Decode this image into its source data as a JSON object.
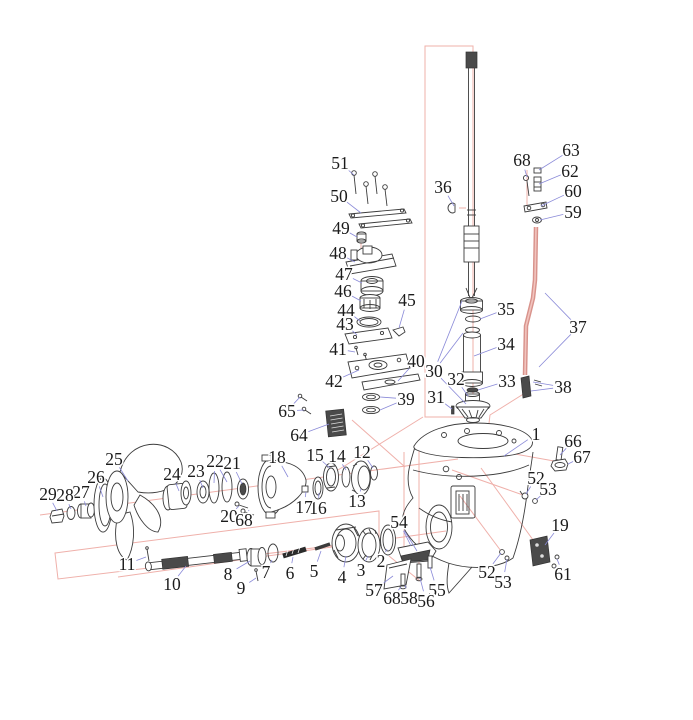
{
  "diagram": {
    "type": "exploded-parts-diagram",
    "colors": {
      "label": "#1b1b1b",
      "leader": "#8a8ad8",
      "assoc": "#efb0aa",
      "ink": "#3c3c3c",
      "rod": "#d8938c"
    },
    "labels": [
      {
        "id": "1",
        "text": "1",
        "x": 536,
        "y": 434,
        "leaders": [
          [
            504,
            456
          ]
        ]
      },
      {
        "id": "2",
        "text": "2",
        "x": 381,
        "y": 561,
        "leaders": [
          [
            387,
            549
          ]
        ]
      },
      {
        "id": "3",
        "text": "3",
        "x": 361,
        "y": 570,
        "leaders": [
          [
            368,
            556
          ]
        ]
      },
      {
        "id": "4",
        "text": "4",
        "x": 342,
        "y": 577,
        "leaders": [
          [
            346,
            556
          ]
        ]
      },
      {
        "id": "5",
        "text": "5",
        "x": 314,
        "y": 571,
        "leaders": [
          [
            321,
            551
          ]
        ]
      },
      {
        "id": "6",
        "text": "6",
        "x": 290,
        "y": 573,
        "leaders": [
          [
            293,
            557
          ]
        ]
      },
      {
        "id": "7",
        "text": "7",
        "x": 266,
        "y": 572,
        "leaders": [
          [
            272,
            560
          ]
        ]
      },
      {
        "id": "8",
        "text": "8",
        "x": 228,
        "y": 574,
        "leaders": [
          [
            250,
            561
          ]
        ]
      },
      {
        "id": "9",
        "text": "9",
        "x": 241,
        "y": 588,
        "leaders": [
          [
            256,
            578
          ]
        ]
      },
      {
        "id": "10",
        "text": "10",
        "x": 172,
        "y": 584,
        "leaders": [
          [
            186,
            566
          ]
        ]
      },
      {
        "id": "11",
        "text": "11",
        "x": 127,
        "y": 564,
        "leaders": [
          [
            146,
            557
          ]
        ]
      },
      {
        "id": "12",
        "text": "12",
        "x": 362,
        "y": 452,
        "leaders": [
          [
            373,
            468
          ]
        ]
      },
      {
        "id": "13",
        "text": "13",
        "x": 357,
        "y": 501,
        "leaders": [
          [
            361,
            489
          ]
        ]
      },
      {
        "id": "14",
        "text": "14",
        "x": 337,
        "y": 456,
        "leaders": [
          [
            346,
            470
          ]
        ]
      },
      {
        "id": "15",
        "text": "15",
        "x": 315,
        "y": 455,
        "leaders": [
          [
            330,
            468
          ]
        ]
      },
      {
        "id": "16",
        "text": "16",
        "x": 318,
        "y": 508,
        "leaders": [
          [
            319,
            493
          ]
        ]
      },
      {
        "id": "17",
        "text": "17",
        "x": 304,
        "y": 507,
        "leaders": [
          [
            306,
            492
          ]
        ]
      },
      {
        "id": "18",
        "text": "18",
        "x": 277,
        "y": 457,
        "leaders": [
          [
            288,
            477
          ]
        ]
      },
      {
        "id": "19",
        "text": "19",
        "x": 560,
        "y": 525,
        "leaders": [
          [
            545,
            545
          ]
        ]
      },
      {
        "id": "20",
        "text": "20",
        "x": 229,
        "y": 516,
        "leaders": [
          [
            239,
            506
          ]
        ]
      },
      {
        "id": "21",
        "text": "21",
        "x": 232,
        "y": 463,
        "leaders": [
          [
            242,
            484
          ]
        ]
      },
      {
        "id": "22",
        "text": "22",
        "x": 215,
        "y": 461,
        "leaders": [
          [
            214,
            483
          ],
          [
            227,
            482
          ]
        ]
      },
      {
        "id": "23",
        "text": "23",
        "x": 196,
        "y": 471,
        "leaders": [
          [
            203,
            488
          ]
        ]
      },
      {
        "id": "24",
        "text": "24",
        "x": 172,
        "y": 474,
        "leaders": [
          [
            179,
            491
          ]
        ]
      },
      {
        "id": "25",
        "text": "25",
        "x": 114,
        "y": 459,
        "leaders": [
          [
            128,
            481
          ]
        ]
      },
      {
        "id": "26",
        "text": "26",
        "x": 96,
        "y": 477,
        "leaders": [
          [
            103,
            497
          ]
        ]
      },
      {
        "id": "27",
        "text": "27",
        "x": 81,
        "y": 492,
        "leaders": [
          [
            86,
            506
          ]
        ]
      },
      {
        "id": "28",
        "text": "28",
        "x": 65,
        "y": 495,
        "leaders": [
          [
            71,
            509
          ]
        ]
      },
      {
        "id": "29",
        "text": "29",
        "x": 48,
        "y": 494,
        "leaders": [
          [
            57,
            511
          ]
        ]
      },
      {
        "id": "30",
        "text": "30",
        "x": 434,
        "y": 371,
        "leaders": [
          [
            462,
            301
          ],
          [
            463,
            333
          ],
          [
            466,
            404
          ]
        ]
      },
      {
        "id": "31",
        "text": "31",
        "x": 436,
        "y": 397,
        "leaders": [
          [
            452,
            409
          ]
        ]
      },
      {
        "id": "32",
        "text": "32",
        "x": 456,
        "y": 379,
        "leaders": [
          [
            468,
            396
          ]
        ]
      },
      {
        "id": "33",
        "text": "33",
        "x": 507,
        "y": 381,
        "leaders": [
          [
            478,
            390
          ]
        ]
      },
      {
        "id": "34",
        "text": "34",
        "x": 506,
        "y": 344,
        "leaders": [
          [
            474,
            356
          ]
        ]
      },
      {
        "id": "35",
        "text": "35",
        "x": 506,
        "y": 309,
        "leaders": [
          [
            480,
            319
          ]
        ]
      },
      {
        "id": "36",
        "text": "36",
        "x": 443,
        "y": 187,
        "leaders": [
          [
            454,
            206
          ]
        ]
      },
      {
        "id": "37",
        "text": "37",
        "x": 578,
        "y": 327,
        "leaders": [
          [
            545,
            293
          ],
          [
            539,
            367
          ]
        ]
      },
      {
        "id": "38",
        "text": "38",
        "x": 563,
        "y": 387,
        "leaders": [
          [
            533,
            382
          ],
          [
            531,
            391
          ]
        ]
      },
      {
        "id": "39",
        "text": "39",
        "x": 406,
        "y": 399,
        "leaders": [
          [
            380,
            397
          ],
          [
            380,
            410
          ]
        ]
      },
      {
        "id": "40",
        "text": "40",
        "x": 416,
        "y": 361,
        "leaders": [
          [
            398,
            381
          ]
        ]
      },
      {
        "id": "41",
        "text": "41",
        "x": 338,
        "y": 349,
        "leaders": [
          [
            355,
            352
          ]
        ]
      },
      {
        "id": "42",
        "text": "42",
        "x": 334,
        "y": 381,
        "leaders": [
          [
            359,
            370
          ]
        ]
      },
      {
        "id": "43",
        "text": "43",
        "x": 345,
        "y": 324,
        "leaders": [
          [
            357,
            335
          ]
        ]
      },
      {
        "id": "44",
        "text": "44",
        "x": 346,
        "y": 310,
        "leaders": [
          [
            360,
            321
          ]
        ]
      },
      {
        "id": "45",
        "text": "45",
        "x": 407,
        "y": 300,
        "leaders": [
          [
            399,
            328
          ]
        ]
      },
      {
        "id": "46",
        "text": "46",
        "x": 343,
        "y": 291,
        "leaders": [
          [
            361,
            301
          ]
        ]
      },
      {
        "id": "47",
        "text": "47",
        "x": 344,
        "y": 274,
        "leaders": [
          [
            362,
            283
          ]
        ]
      },
      {
        "id": "48",
        "text": "48",
        "x": 338,
        "y": 253,
        "leaders": [
          [
            355,
            262
          ]
        ]
      },
      {
        "id": "49",
        "text": "49",
        "x": 341,
        "y": 228,
        "leaders": [
          [
            357,
            237
          ]
        ]
      },
      {
        "id": "50",
        "text": "50",
        "x": 339,
        "y": 196,
        "leaders": [
          [
            361,
            213
          ]
        ]
      },
      {
        "id": "51",
        "text": "51",
        "x": 340,
        "y": 163,
        "leaders": [
          [
            354,
            175
          ]
        ]
      },
      {
        "id": "52a",
        "text": "52",
        "x": 536,
        "y": 478,
        "leaders": [
          [
            526,
            494
          ]
        ]
      },
      {
        "id": "53a",
        "text": "53",
        "x": 548,
        "y": 489,
        "leaders": [
          [
            536,
            500
          ]
        ]
      },
      {
        "id": "52b",
        "text": "52",
        "x": 487,
        "y": 572,
        "leaders": [
          [
            501,
            553
          ]
        ]
      },
      {
        "id": "53b",
        "text": "53",
        "x": 503,
        "y": 582,
        "leaders": [
          [
            507,
            559
          ]
        ]
      },
      {
        "id": "54",
        "text": "54",
        "x": 399,
        "y": 522,
        "leaders": [
          [
            411,
            546
          ],
          [
            417,
            551
          ]
        ]
      },
      {
        "id": "55",
        "text": "55",
        "x": 437,
        "y": 590,
        "leaders": [
          [
            430,
            567
          ]
        ]
      },
      {
        "id": "56",
        "text": "56",
        "x": 426,
        "y": 601,
        "leaders": [
          [
            420,
            578
          ]
        ]
      },
      {
        "id": "57",
        "text": "57",
        "x": 374,
        "y": 590,
        "leaders": [
          [
            393,
            576
          ]
        ]
      },
      {
        "id": "58",
        "text": "58",
        "x": 409,
        "y": 598,
        "leaders": [
          [
            405,
            585
          ]
        ]
      },
      {
        "id": "59",
        "text": "59",
        "x": 573,
        "y": 212,
        "leaders": [
          [
            540,
            220
          ]
        ]
      },
      {
        "id": "60",
        "text": "60",
        "x": 573,
        "y": 191,
        "leaders": [
          [
            541,
            206
          ]
        ]
      },
      {
        "id": "61",
        "text": "61",
        "x": 563,
        "y": 574,
        "leaders": [
          [
            557,
            559
          ],
          [
            555,
            567
          ]
        ]
      },
      {
        "id": "62",
        "text": "62",
        "x": 570,
        "y": 171,
        "leaders": [
          [
            539,
            184
          ]
        ]
      },
      {
        "id": "63",
        "text": "63",
        "x": 571,
        "y": 150,
        "leaders": [
          [
            539,
            170
          ]
        ]
      },
      {
        "id": "64",
        "text": "64",
        "x": 299,
        "y": 435,
        "leaders": [
          [
            329,
            424
          ]
        ]
      },
      {
        "id": "65",
        "text": "65",
        "x": 287,
        "y": 411,
        "leaders": [
          [
            300,
            397
          ],
          [
            304,
            410
          ]
        ]
      },
      {
        "id": "66",
        "text": "66",
        "x": 573,
        "y": 441,
        "leaders": [
          [
            560,
            455
          ]
        ]
      },
      {
        "id": "67",
        "text": "67",
        "x": 582,
        "y": 457,
        "leaders": [
          [
            568,
            464
          ]
        ]
      },
      {
        "id": "68a",
        "text": "68",
        "x": 244,
        "y": 520,
        "leaders": [
          [
            249,
            510
          ]
        ]
      },
      {
        "id": "68b",
        "text": "68",
        "x": 522,
        "y": 160,
        "leaders": [
          [
            527,
            177
          ]
        ]
      },
      {
        "id": "68c",
        "text": "68",
        "x": 392,
        "y": 598,
        "leaders": [
          [
            401,
            587
          ]
        ]
      }
    ]
  }
}
